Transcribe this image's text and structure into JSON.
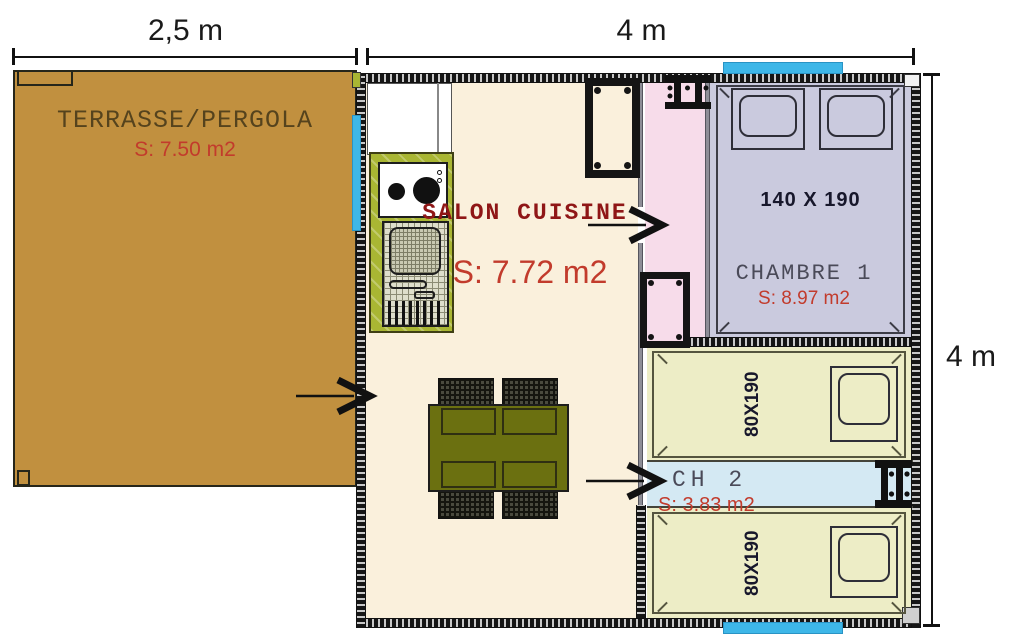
{
  "plan": {
    "dimensions": {
      "top_left": "2,5 m",
      "top_right": "4 m",
      "right_side": "4 m"
    },
    "terrace": {
      "label": "TERRASSE/PERGOLA",
      "area": "S: 7.50 m2"
    },
    "salon": {
      "label": "SALON CUISINE",
      "area": "S: 7.72 m2"
    },
    "chambre1": {
      "label": "CHAMBRE 1",
      "area": "S: 8.97 m2",
      "bed_size": "140 X 190"
    },
    "ch2": {
      "label": "CH 2",
      "area": "S: 3.83 m2",
      "bed_top": "80X190",
      "bed_bottom": "80X190"
    },
    "colors": {
      "terrace": "#c1903f",
      "salon_floor": "#faf0dc",
      "hall_pink": "#f7dcea",
      "chambre1_floor": "#cacade",
      "bedroom_yellow": "#ededc6",
      "corridor_blue": "#d4e9f3",
      "window_blue": "#3eb7e8",
      "kitchen_olive": "#a9b633",
      "table_olive": "#6b7010",
      "area_red": "#c23b2c",
      "salon_title_red": "#8f1616",
      "label_grey": "#4a4a58"
    }
  }
}
